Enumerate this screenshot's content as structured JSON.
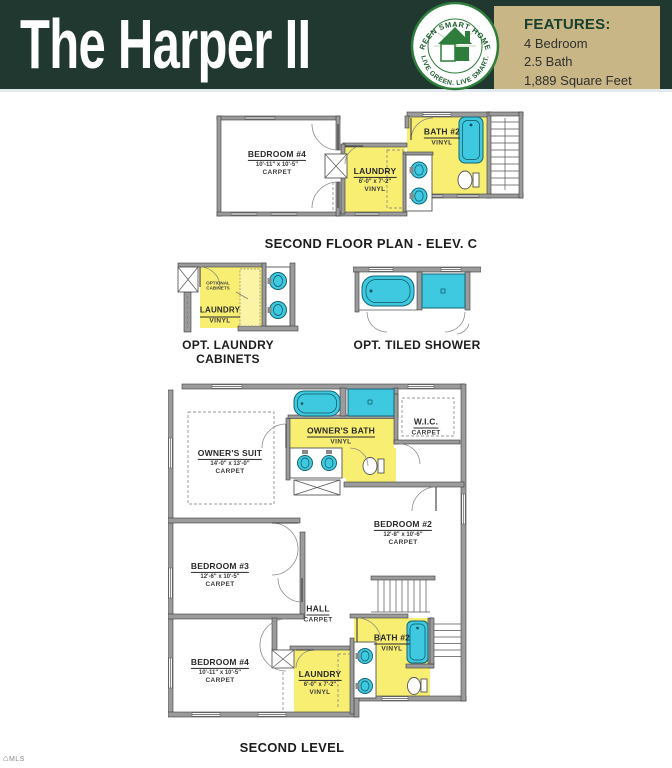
{
  "header": {
    "title": "The Harper II",
    "logo": {
      "arc_top": "GREEN SMART HOMES",
      "arc_bottom": "LIVE GREEN. LIVE SMART."
    },
    "features": {
      "heading": "FEATURES:",
      "items": [
        "4 Bedroom",
        "2.5 Bath",
        "1,889 Square Feet"
      ]
    }
  },
  "plans": {
    "second_floor_elev_c": {
      "caption": "SECOND FLOOR PLAN - ELEV. C",
      "rooms": {
        "bedroom4": {
          "name": "BEDROOM #4",
          "dims": "10'-11\" x 10'-5\"",
          "floor": "CARPET"
        },
        "laundry": {
          "name": "LAUNDRY",
          "dims": "6'-0\" x 7'-2\"",
          "floor": "VINYL"
        },
        "bath2": {
          "name": "BATH #2",
          "floor": "VINYL"
        }
      }
    },
    "opt_laundry_cabinets": {
      "caption": "OPT. LAUNDRY CABINETS",
      "note": "OPTIONAL CABINETS",
      "rooms": {
        "laundry": {
          "name": "LAUNDRY",
          "floor": "VINYL"
        }
      }
    },
    "opt_tiled_shower": {
      "caption": "OPT. TILED SHOWER"
    },
    "second_level": {
      "caption": "SECOND LEVEL",
      "rooms": {
        "owners_suite": {
          "name": "OWNER'S SUIT",
          "dims": "14'-0\" x 13'-0\"",
          "floor": "CARPET"
        },
        "owners_bath": {
          "name": "OWNER'S BATH",
          "floor": "VINYL"
        },
        "wic": {
          "name": "W.I.C.",
          "floor": "CARPET"
        },
        "bedroom2": {
          "name": "BEDROOM #2",
          "dims": "12'-8\" x 10'-6\"",
          "floor": "CARPET"
        },
        "bedroom3": {
          "name": "BEDROOM #3",
          "dims": "12'-6\" x 10'-5\"",
          "floor": "CARPET"
        },
        "hall": {
          "name": "HALL",
          "floor": "CARPET"
        },
        "bedroom4": {
          "name": "BEDROOM #4",
          "dims": "10'-11\" x 10'-5\"",
          "floor": "CARPET"
        },
        "bath2": {
          "name": "BATH #2",
          "floor": "VINYL"
        },
        "laundry": {
          "name": "LAUNDRY",
          "dims": "6'-0\" x 7'-2\"",
          "floor": "VINYL"
        }
      }
    }
  },
  "watermark": {
    "text": "MLS"
  },
  "colors": {
    "header_green": "#20382f",
    "tan": "#c9b687",
    "room_yellow": "#f8ee72",
    "fixture_cyan": "#3ec9e0",
    "wall_gray": "#9b9b9b"
  }
}
